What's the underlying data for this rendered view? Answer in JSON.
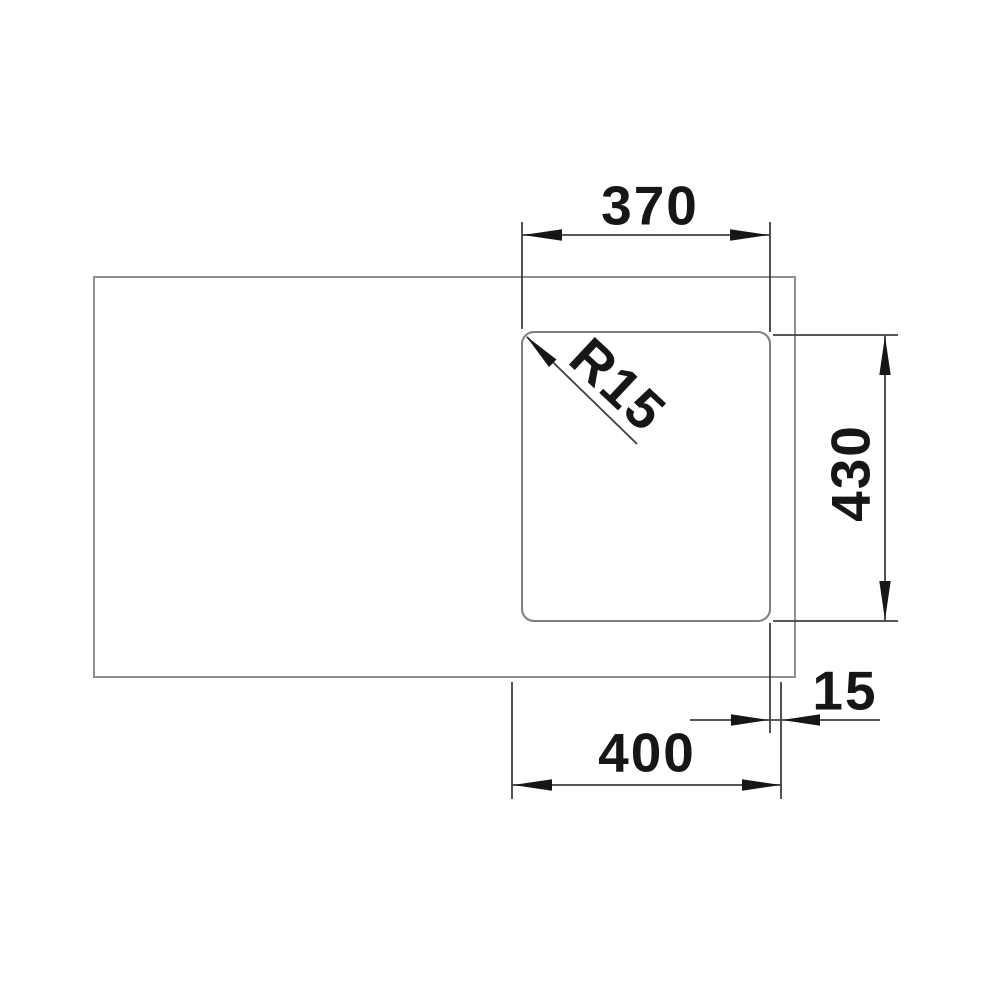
{
  "drawing": {
    "type": "technical-dimension-drawing",
    "view": "sink-top-view",
    "dimensions": {
      "bowl_width": "370",
      "bowl_depth": "430",
      "corner_radius": "R15",
      "cutout_width": "400",
      "edge_offset": "15"
    }
  },
  "colors": {
    "background": "#ffffff",
    "object_line": "#8f8f8f",
    "bowl_line": "#7e7e7e",
    "dimension_line": "#3f3f3f",
    "label_text": "#161616"
  }
}
